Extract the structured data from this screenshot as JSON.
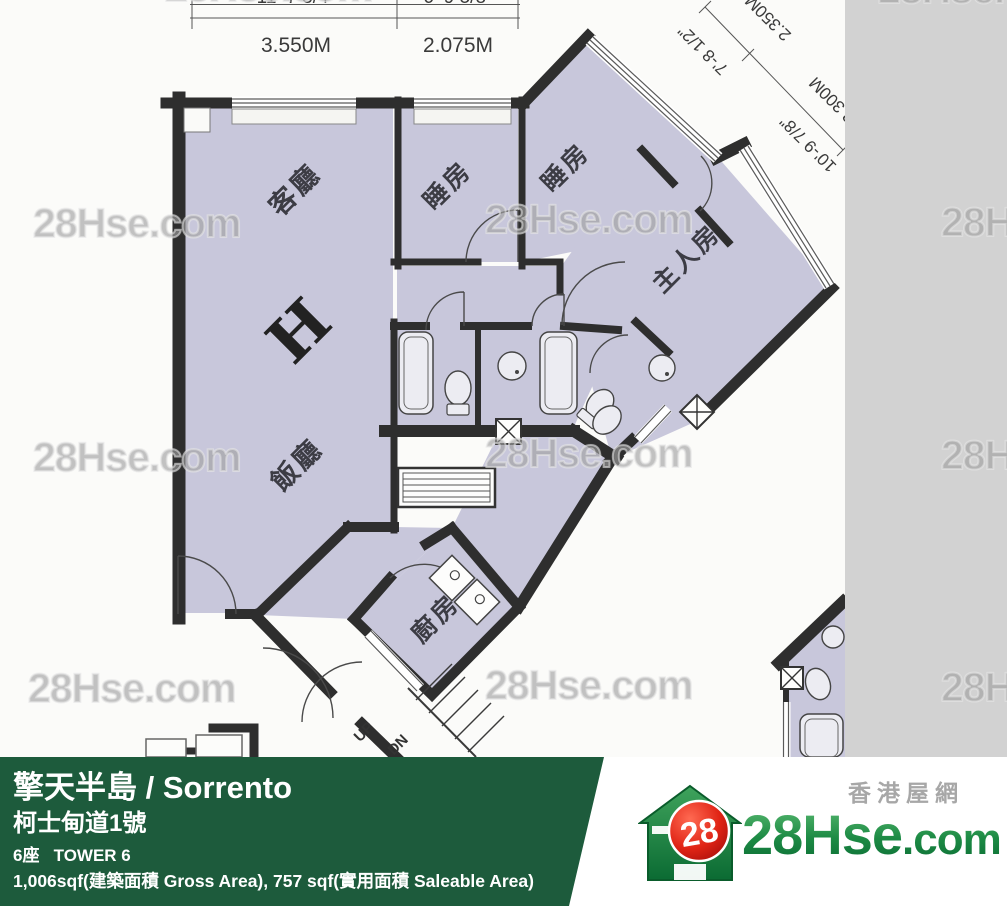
{
  "watermark": {
    "text": "28Hse.com"
  },
  "plan": {
    "unit_letter": "H",
    "rooms": {
      "living": "客廳",
      "dining": "飯廳",
      "bedroom1": "睡房",
      "bedroom2": "睡房",
      "master": "主人房",
      "kitchen": "廚房"
    },
    "stairs": {
      "up": "UP",
      "down": "DN"
    },
    "dims": {
      "top_m1": "3.550M",
      "top_m2": "2.075M",
      "top_ft1": "11'-7 3/4\"",
      "top_ft2": "6'-9 5/8\"",
      "diag_ft1": "7'-8 1/2\"",
      "diag_m1": "2.350M",
      "diag_ft2": "10'-9 7/8\"",
      "diag_m2": "3.300M"
    }
  },
  "footer": {
    "estate_title": "擎天半島 / Sorrento",
    "address": "柯士甸道1號",
    "tower": "6座   TOWER 6",
    "area": "1,006sqf(建築面積 Gross Area), 757 sqf(實用面積 Saleable Area)"
  },
  "logo": {
    "badge": "28",
    "brand": "28Hse",
    "brand_suffix": ".com",
    "tagline": "香港屋網"
  }
}
